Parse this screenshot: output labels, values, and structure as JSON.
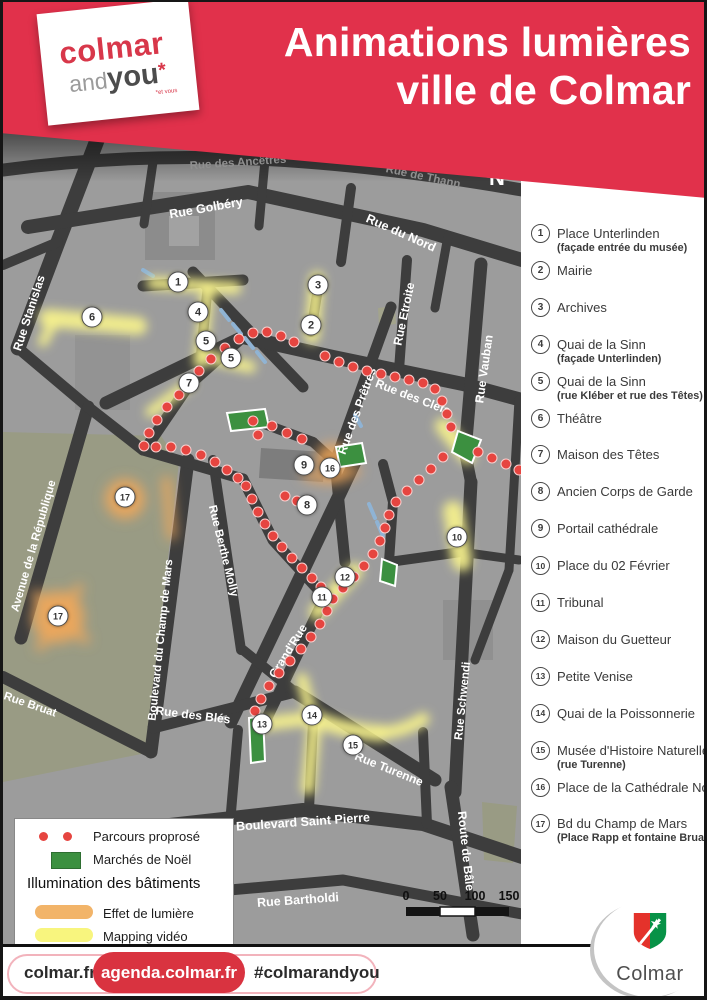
{
  "header": {
    "title_line1": "Animations lumières",
    "title_line2": "ville de Colmar",
    "logo": {
      "part1": "colmar",
      "part2": "and",
      "part3": "you",
      "asterisk": "*",
      "tagline": "*et vous"
    }
  },
  "map": {
    "north_label": "N",
    "scale_labels": [
      "0",
      "50",
      "100",
      "150"
    ],
    "streets": [
      {
        "name": "Rue des Ancêtres",
        "x": 235,
        "y": 33,
        "rot": -4,
        "color": "#8f8f8f",
        "fs": 11.5
      },
      {
        "name": "Rue de Thann",
        "x": 420,
        "y": 47,
        "rot": 12,
        "color": "#8f8f8f",
        "fs": 11.5
      },
      {
        "name": "Rue Golbéry",
        "x": 203,
        "y": 78,
        "rot": -10,
        "color": "#ffffff",
        "fs": 12.5
      },
      {
        "name": "Rue du Nord",
        "x": 398,
        "y": 103,
        "rot": 24,
        "color": "#ffffff",
        "fs": 12.5
      },
      {
        "name": "Rue Etroite",
        "x": 401,
        "y": 184,
        "rot": -78,
        "color": "#ffffff",
        "fs": 12
      },
      {
        "name": "Rue Vauban",
        "x": 481,
        "y": 239,
        "rot": -82,
        "color": "#ffffff",
        "fs": 12
      },
      {
        "name": "Rue Stanislas",
        "x": 26,
        "y": 183,
        "rot": -72,
        "color": "#ffffff",
        "fs": 12
      },
      {
        "name": "Rue des Prêtres",
        "x": 354,
        "y": 281,
        "rot": -70,
        "color": "#ffffff",
        "fs": 12
      },
      {
        "name": "Rue des Clefs",
        "x": 410,
        "y": 267,
        "rot": 21,
        "color": "#ffffff",
        "fs": 12
      },
      {
        "name": "Rue Berthe Molly",
        "x": 220,
        "y": 421,
        "rot": 76,
        "color": "#ffffff",
        "fs": 11.5
      },
      {
        "name": "Avenue de la République",
        "x": 31,
        "y": 416,
        "rot": -74,
        "color": "#ffffff",
        "fs": 11.5
      },
      {
        "name": "Boulevard du Champ de Mars",
        "x": 158,
        "y": 510,
        "rot": -84,
        "color": "#ffffff",
        "fs": 11.5
      },
      {
        "name": "Grand'Rue",
        "x": 285,
        "y": 521,
        "rot": -58,
        "color": "#ffffff",
        "fs": 12
      },
      {
        "name": "Rue des Blés",
        "x": 190,
        "y": 585,
        "rot": 7,
        "color": "#ffffff",
        "fs": 12
      },
      {
        "name": "Rue Turenne",
        "x": 386,
        "y": 639,
        "rot": 22,
        "color": "#ffffff",
        "fs": 12
      },
      {
        "name": "Rue Schwendi",
        "x": 460,
        "y": 571,
        "rot": -84,
        "color": "#ffffff",
        "fs": 11.5
      },
      {
        "name": "Boulevard Saint Pierre",
        "x": 300,
        "y": 692,
        "rot": -4,
        "color": "#ffffff",
        "fs": 12.5
      },
      {
        "name": "Route de Bâle",
        "x": 463,
        "y": 721,
        "rot": 84,
        "color": "#ffffff",
        "fs": 12
      },
      {
        "name": "Rue Bartholdi",
        "x": 295,
        "y": 770,
        "rot": -4,
        "color": "#ffffff",
        "fs": 12.5
      },
      {
        "name": "Rue Bruat",
        "x": 27,
        "y": 575,
        "rot": 19,
        "color": "#ffffff",
        "fs": 11.5
      }
    ],
    "markers": [
      {
        "n": "1",
        "x": 175,
        "y": 152
      },
      {
        "n": "2",
        "x": 308,
        "y": 195
      },
      {
        "n": "3",
        "x": 315,
        "y": 155
      },
      {
        "n": "4",
        "x": 195,
        "y": 182
      },
      {
        "n": "5",
        "x": 203,
        "y": 211
      },
      {
        "n": "5",
        "x": 228,
        "y": 228
      },
      {
        "n": "6",
        "x": 89,
        "y": 187
      },
      {
        "n": "7",
        "x": 186,
        "y": 253
      },
      {
        "n": "8",
        "x": 304,
        "y": 375
      },
      {
        "n": "9",
        "x": 301,
        "y": 335
      },
      {
        "n": "16",
        "x": 327,
        "y": 338
      },
      {
        "n": "10",
        "x": 454,
        "y": 407
      },
      {
        "n": "11",
        "x": 319,
        "y": 467
      },
      {
        "n": "12",
        "x": 342,
        "y": 447
      },
      {
        "n": "13",
        "x": 259,
        "y": 594
      },
      {
        "n": "14",
        "x": 309,
        "y": 585
      },
      {
        "n": "15",
        "x": 350,
        "y": 615
      },
      {
        "n": "17",
        "x": 122,
        "y": 367
      },
      {
        "n": "17",
        "x": 55,
        "y": 486
      }
    ],
    "route_dots": [
      [
        176,
        265
      ],
      [
        164,
        277
      ],
      [
        154,
        290
      ],
      [
        146,
        303
      ],
      [
        141,
        316
      ],
      [
        153,
        317
      ],
      [
        168,
        317
      ],
      [
        183,
        320
      ],
      [
        198,
        325
      ],
      [
        212,
        332
      ],
      [
        224,
        340
      ],
      [
        235,
        348
      ],
      [
        196,
        241
      ],
      [
        208,
        229
      ],
      [
        222,
        218
      ],
      [
        236,
        209
      ],
      [
        250,
        203
      ],
      [
        264,
        202
      ],
      [
        278,
        206
      ],
      [
        291,
        212
      ],
      [
        322,
        226
      ],
      [
        336,
        232
      ],
      [
        350,
        237
      ],
      [
        364,
        241
      ],
      [
        378,
        244
      ],
      [
        392,
        247
      ],
      [
        406,
        250
      ],
      [
        420,
        253
      ],
      [
        432,
        259
      ],
      [
        439,
        271
      ],
      [
        444,
        284
      ],
      [
        448,
        297
      ],
      [
        440,
        327
      ],
      [
        428,
        339
      ],
      [
        416,
        350
      ],
      [
        404,
        361
      ],
      [
        393,
        372
      ],
      [
        386,
        385
      ],
      [
        382,
        398
      ],
      [
        377,
        411
      ],
      [
        370,
        424
      ],
      [
        361,
        436
      ],
      [
        351,
        447
      ],
      [
        340,
        458
      ],
      [
        330,
        469
      ],
      [
        243,
        356
      ],
      [
        249,
        369
      ],
      [
        255,
        382
      ],
      [
        262,
        394
      ],
      [
        270,
        406
      ],
      [
        279,
        417
      ],
      [
        289,
        428
      ],
      [
        299,
        438
      ],
      [
        309,
        448
      ],
      [
        318,
        457
      ],
      [
        324,
        481
      ],
      [
        317,
        494
      ],
      [
        308,
        507
      ],
      [
        298,
        519
      ],
      [
        287,
        531
      ],
      [
        276,
        543
      ],
      [
        266,
        556
      ],
      [
        258,
        569
      ],
      [
        252,
        581
      ],
      [
        250,
        291
      ],
      [
        255,
        305
      ],
      [
        282,
        366
      ],
      [
        294,
        371
      ],
      [
        475,
        322
      ],
      [
        489,
        328
      ],
      [
        503,
        334
      ],
      [
        516,
        340
      ],
      [
        269,
        296
      ],
      [
        284,
        303
      ],
      [
        299,
        309
      ]
    ]
  },
  "legend": {
    "route_label": "Parcours proprosé",
    "market_label": "Marchés de Noël",
    "illumination_title": "Illumination des bâtiments",
    "light_label": "Effet de lumière",
    "mapping_label": "Mapping vidéo",
    "route_color": "#e64540",
    "market_color": "#3c9040",
    "light_color": "#f2b469",
    "mapping_color": "#f8f57e"
  },
  "sidebar": {
    "items": [
      {
        "num": "1",
        "label": "Place Unterlinden",
        "sub": "(façade entrée du musée)"
      },
      {
        "num": "2",
        "label": "Mairie"
      },
      {
        "num": "3",
        "label": "Archives"
      },
      {
        "num": "4",
        "label": "Quai de la Sinn",
        "sub": "(façade Unterlinden)"
      },
      {
        "num": "5",
        "label": "Quai de la Sinn",
        "sub": "(rue Kléber et rue des Têtes)"
      },
      {
        "num": "6",
        "label": "Théâtre"
      },
      {
        "num": "7",
        "label": "Maison des Têtes"
      },
      {
        "num": "8",
        "label": "Ancien Corps de Garde"
      },
      {
        "num": "9",
        "label": "Portail cathédrale"
      },
      {
        "num": "10",
        "label": "Place du 02 Février"
      },
      {
        "num": "11",
        "label": "Tribunal"
      },
      {
        "num": "12",
        "label": "Maison du Guetteur"
      },
      {
        "num": "13",
        "label": "Petite Venise"
      },
      {
        "num": "14",
        "label": "Quai de la Poissonnerie"
      },
      {
        "num": "15",
        "label": "Musée d'Histoire Naturelle",
        "sub": "(rue Turenne)"
      },
      {
        "num": "16",
        "label": "Place de la Cathédrale Nord"
      },
      {
        "num": "17",
        "label": "Bd du Champ de Mars",
        "sub": "(Place Rapp et fontaine Bruat)"
      }
    ]
  },
  "footer": {
    "link1": "colmar.fr",
    "link2": "agenda.colmar.fr",
    "hashtag": "#colmarandyou",
    "city_logo_text": "Colmar"
  }
}
